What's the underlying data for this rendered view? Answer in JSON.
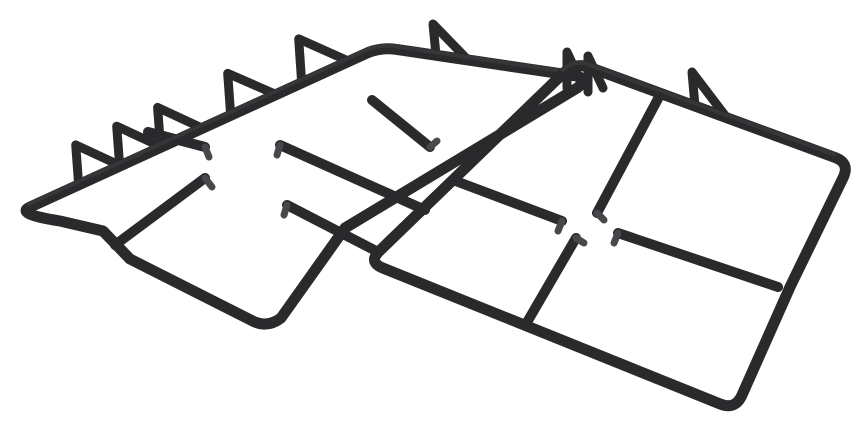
{
  "image": {
    "description": "Two black cast-iron pan support grates for a gas hob, overlapping diagonally on a plain white background, viewed in perspective",
    "object": "cast-iron pan support grates",
    "grate_count": 2,
    "background_color": "#ffffff"
  },
  "colors": {
    "iron": "#2a2a2d",
    "iron_highlight": "#3f3f44",
    "nub_tip": "#47474c",
    "background": "#ffffff"
  },
  "left_grate": {
    "name": "left-pan-support",
    "rear_prongs": 6,
    "finger_bars": 5
  },
  "right_grate": {
    "name": "right-pan-support",
    "rear_prongs": 1,
    "corner_tabs": 2,
    "finger_bars": 4
  }
}
